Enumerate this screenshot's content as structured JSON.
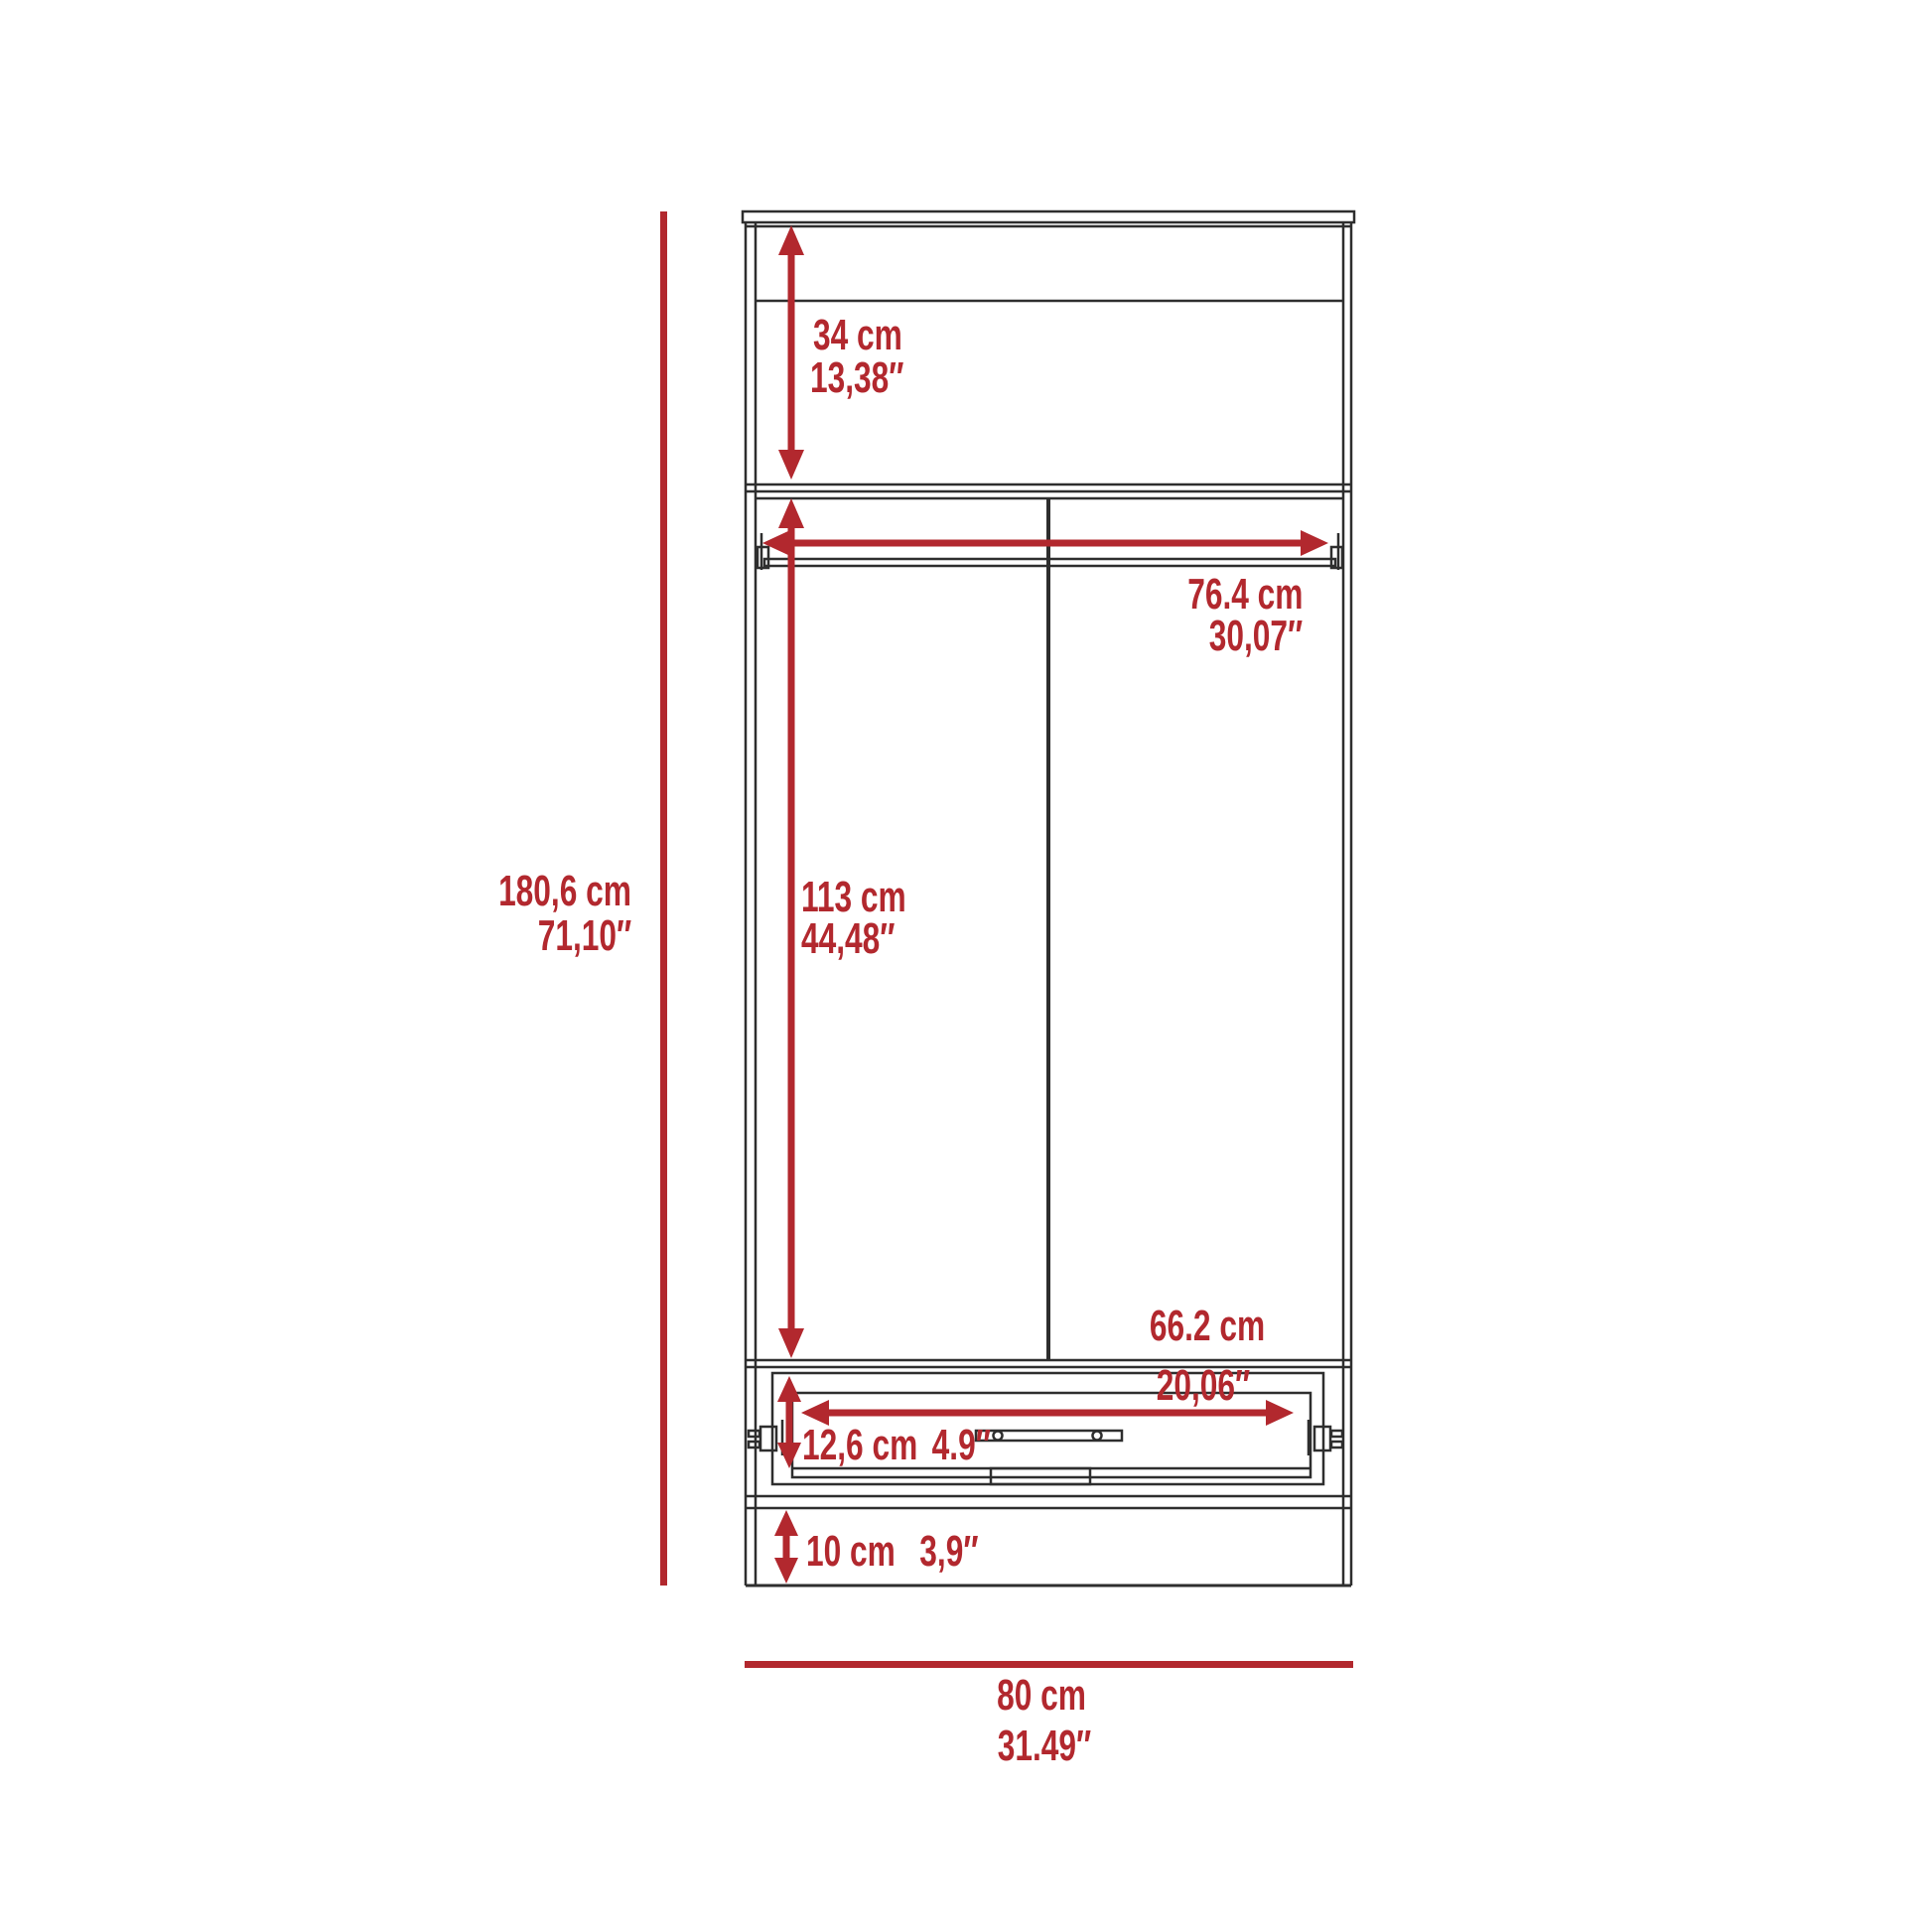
{
  "diagram": {
    "colors": {
      "dimension_red": "#b2282e",
      "outline_dark": "#2e2e2e",
      "background": "#ffffff"
    },
    "labels": {
      "overall_height_cm": "180,6 cm",
      "overall_height_in": "71,10″",
      "top_section_height_cm": "34 cm",
      "top_section_height_in": "13,38″",
      "rod_width_cm": "76.4 cm",
      "rod_width_in": "30,07″",
      "door_section_height_cm": "113 cm",
      "door_section_height_in": "44,48″",
      "drawer_width_cm": "66.2 cm",
      "drawer_width_in": "20,06″",
      "drawer_height_cm": "12,6 cm",
      "drawer_height_in": "4.9″",
      "base_height_cm": "10 cm",
      "base_height_in": "3,9″",
      "overall_width_cm": "80 cm",
      "overall_width_in": "31.49″"
    }
  }
}
